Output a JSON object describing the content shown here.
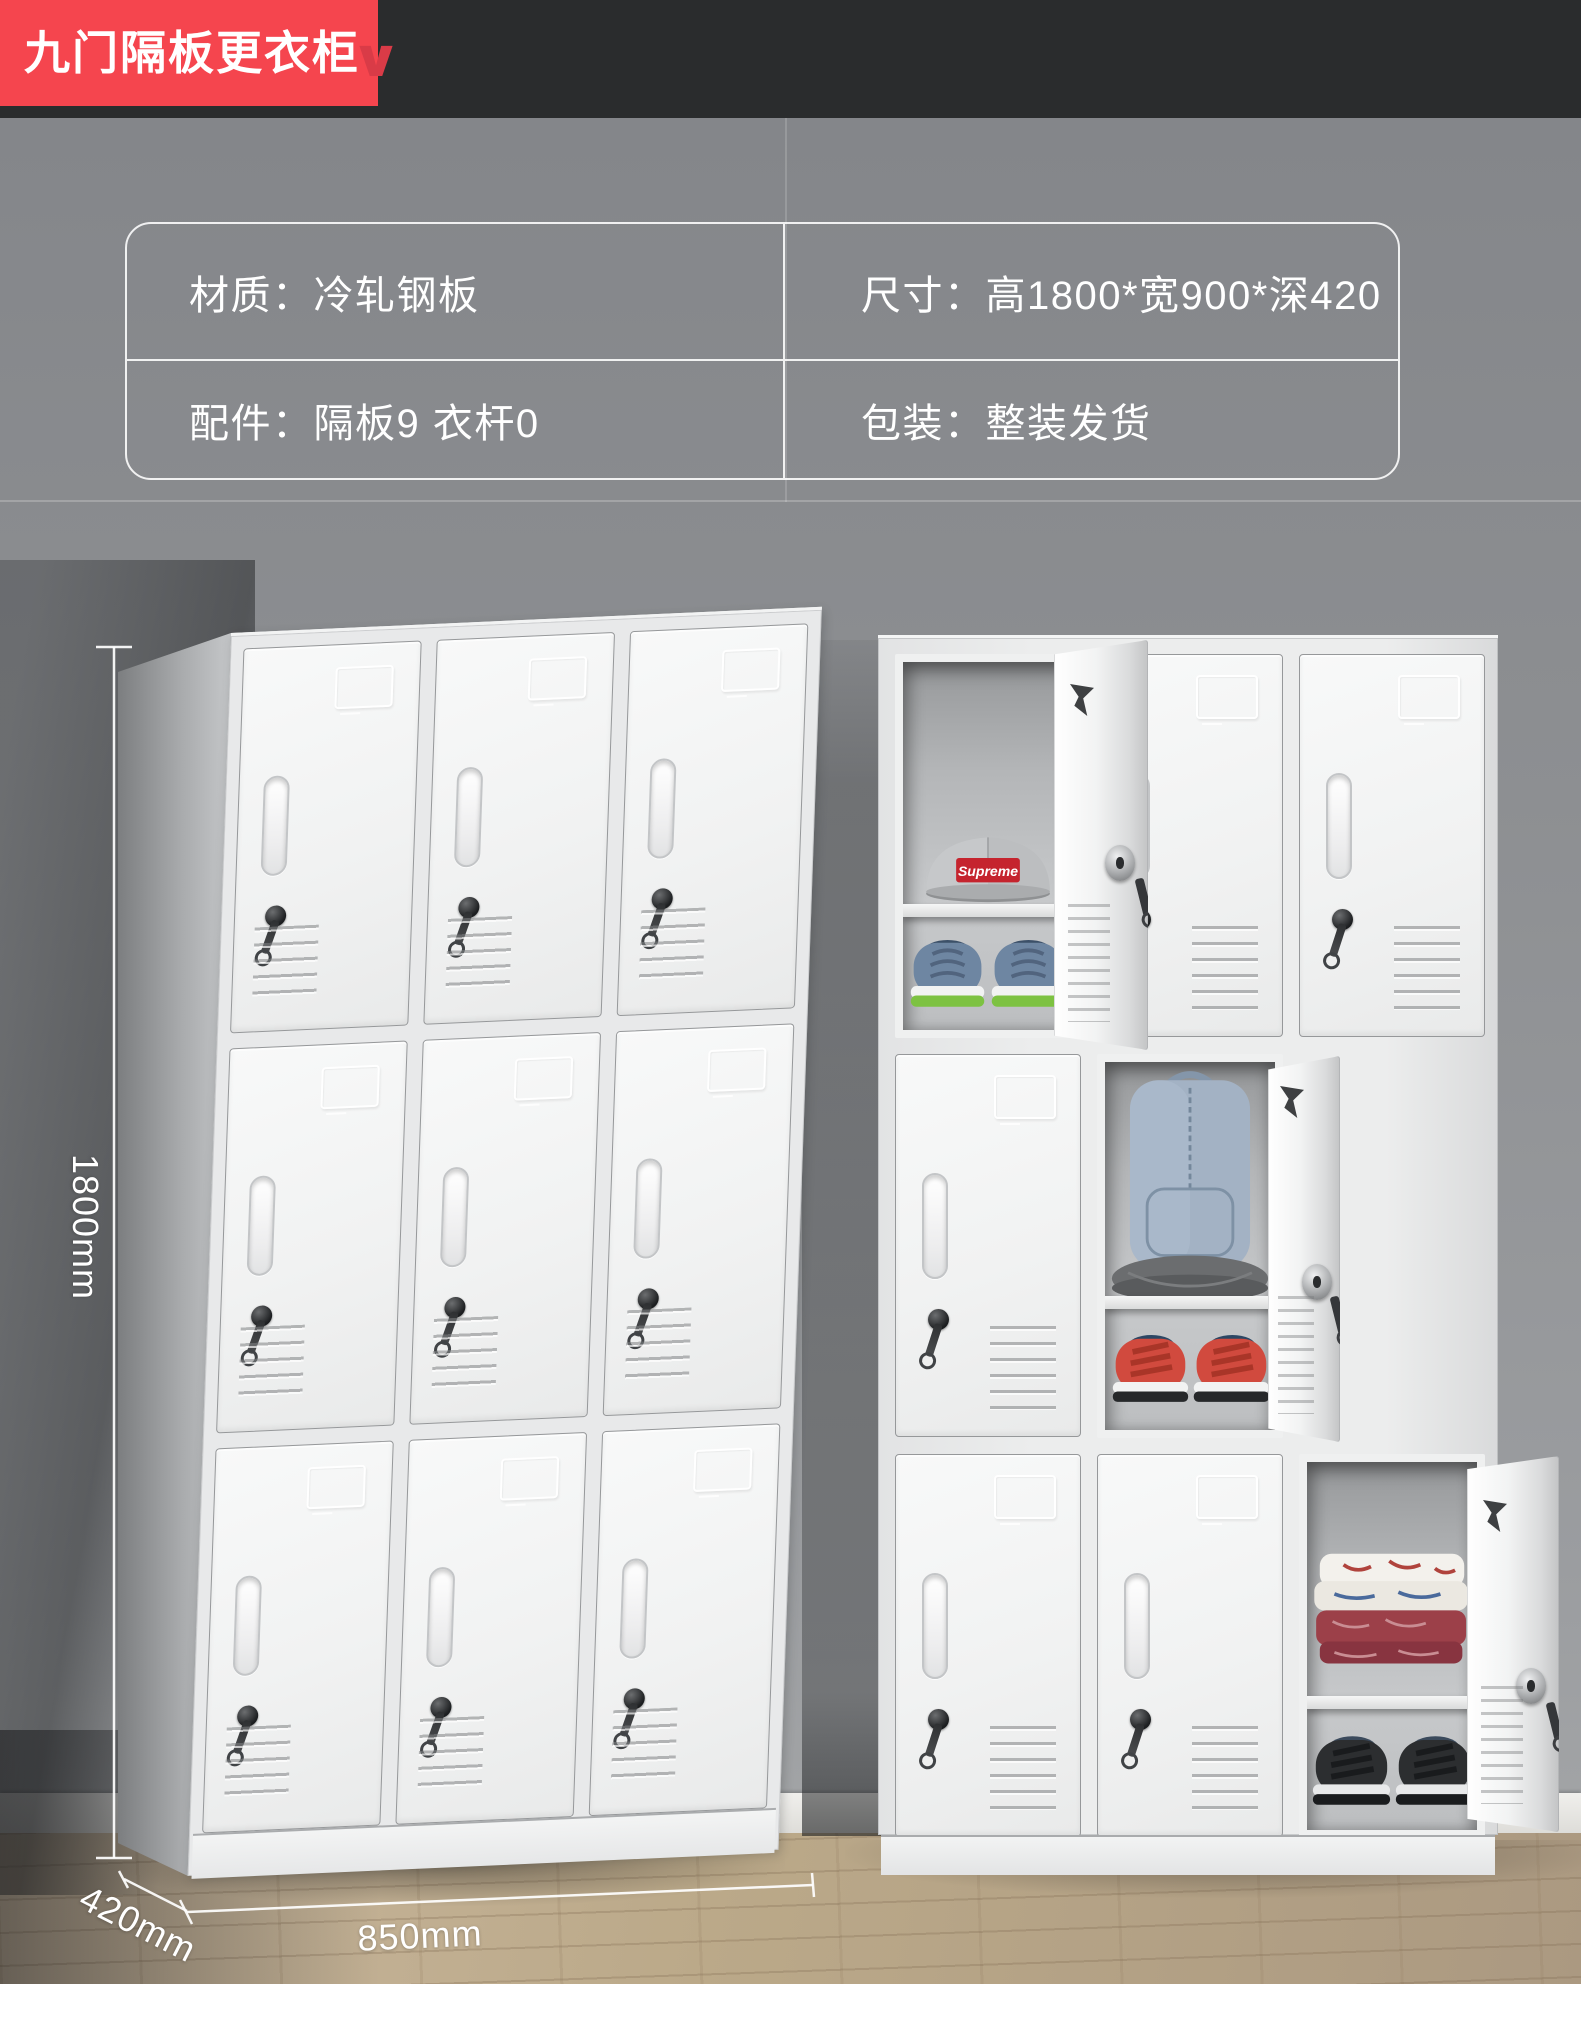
{
  "header": {
    "title": "九门隔板更衣柜",
    "chevron_icon": "∨"
  },
  "spec_table": {
    "cells": [
      {
        "text": "材质：冷轧钢板"
      },
      {
        "text": "尺寸：高1800*宽900*深420"
      },
      {
        "text": "配件：隔板9  衣杆0"
      },
      {
        "text": "包装：整装发货"
      }
    ]
  },
  "dimensions": {
    "height_label": "1800mm",
    "depth_label": "420mm",
    "width_label": "850mm"
  },
  "items": {
    "cap_logo": "Supreme"
  },
  "colors": {
    "accent_red": "#f5454e",
    "header_dark": "#2a2c2d",
    "wall_gray": "#8f9194",
    "locker_white": "#f2f3f3",
    "floor_wood": "#b9a78c",
    "text_white": "#ffffff",
    "cap_logo_red": "#c5242e",
    "sneaker_green": "#7dc242",
    "shoe_red": "#d14a3e",
    "backpack_blue": "#a3b2c4",
    "blanket_red": "#9c4049"
  }
}
